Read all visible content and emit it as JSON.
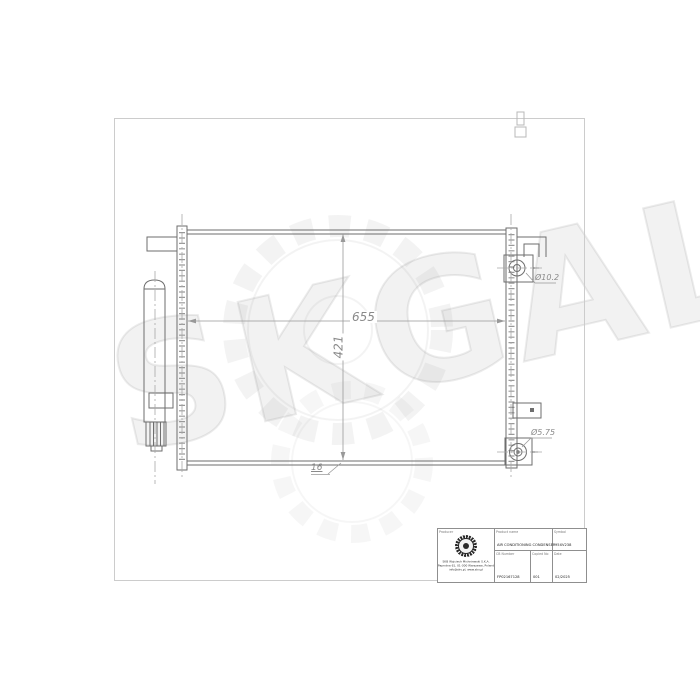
{
  "watermark": {
    "text": "SKGAL"
  },
  "drawing": {
    "dims": {
      "width": "655",
      "height": "421",
      "thickness": "16",
      "inlet_port": "Ø10.2",
      "outlet_port": "Ø5.75"
    }
  },
  "title_block": {
    "producer_label": "Producer",
    "product_label": "Product name",
    "product_value": "AIR CONDITIONING CONDENSER",
    "symbol_label": "Symbol",
    "symbol_value": "95XV238",
    "number_label": "CB Number",
    "number_value": "FP02167128",
    "copy_label": "Copied No",
    "copy_value": "001",
    "date_label": "Date",
    "date_value": "02/2025",
    "company_line1": "SKB Wojciech Michniewski S.K.A.",
    "company_line2": "Paprotna 61, 01-300 Warszawa, Poland",
    "company_line3": "info@skv.pl, www.skv.pl"
  }
}
